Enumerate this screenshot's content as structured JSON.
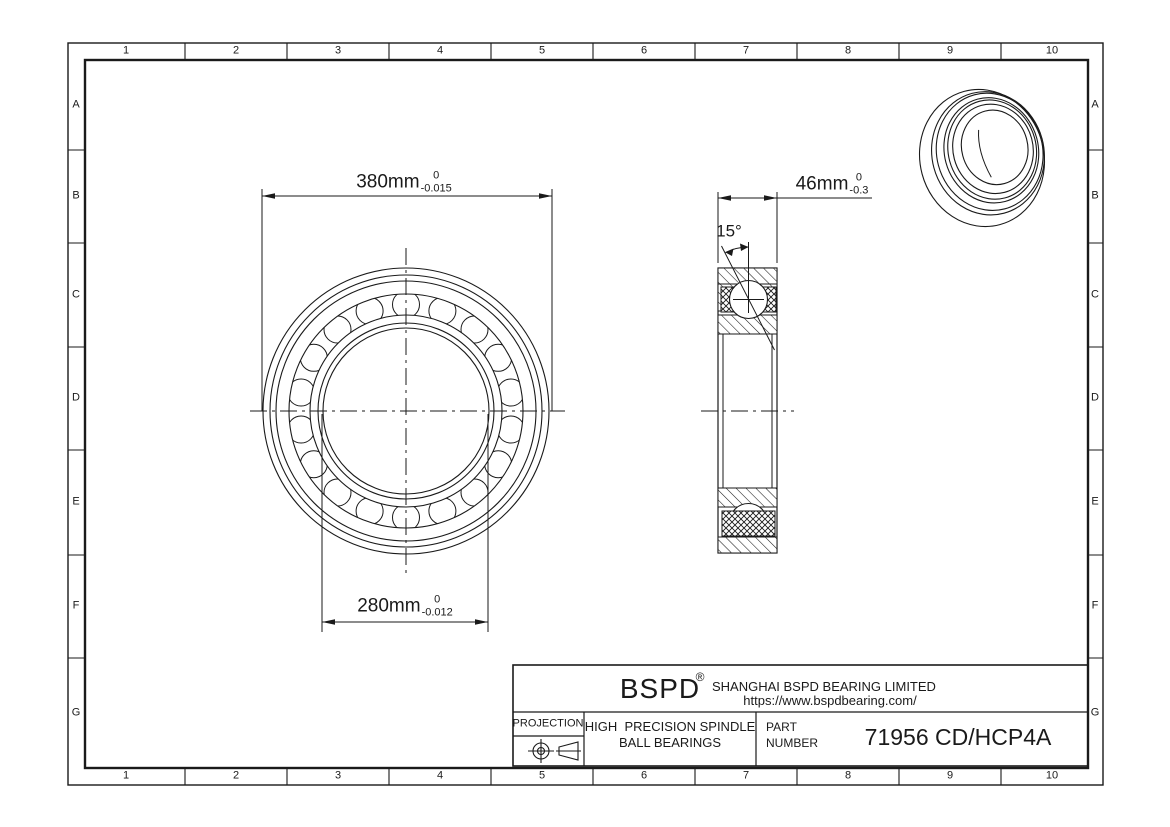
{
  "colors": {
    "line": "#1a1a1a",
    "background": "#ffffff"
  },
  "frame": {
    "columns": [
      "1",
      "2",
      "3",
      "4",
      "5",
      "6",
      "7",
      "8",
      "9",
      "10"
    ],
    "rows": [
      "A",
      "B",
      "C",
      "D",
      "E",
      "F",
      "G"
    ]
  },
  "dimensions": {
    "outer_diameter": {
      "value": "380mm",
      "tol_upper": "0",
      "tol_lower": "-0.015"
    },
    "bore_diameter": {
      "value": "280mm",
      "tol_upper": "0",
      "tol_lower": "-0.012"
    },
    "width": {
      "value": "46mm",
      "tol_upper": "0",
      "tol_lower": "-0.3"
    },
    "contact_angle": "15°"
  },
  "title_block": {
    "logo": "BSPD",
    "registered_mark": "®",
    "company": "SHANGHAI BSPD BEARING LIMITED",
    "website": "https://www.bspdbearing.com/",
    "projection_label": "PROJECTION",
    "product_line1": "HIGH  PRECISION SPINDLE",
    "product_line2": "BALL BEARINGS",
    "part_label_line1": "PART",
    "part_label_line2": "NUMBER",
    "part_number": "71956 CD/HCP4A"
  }
}
